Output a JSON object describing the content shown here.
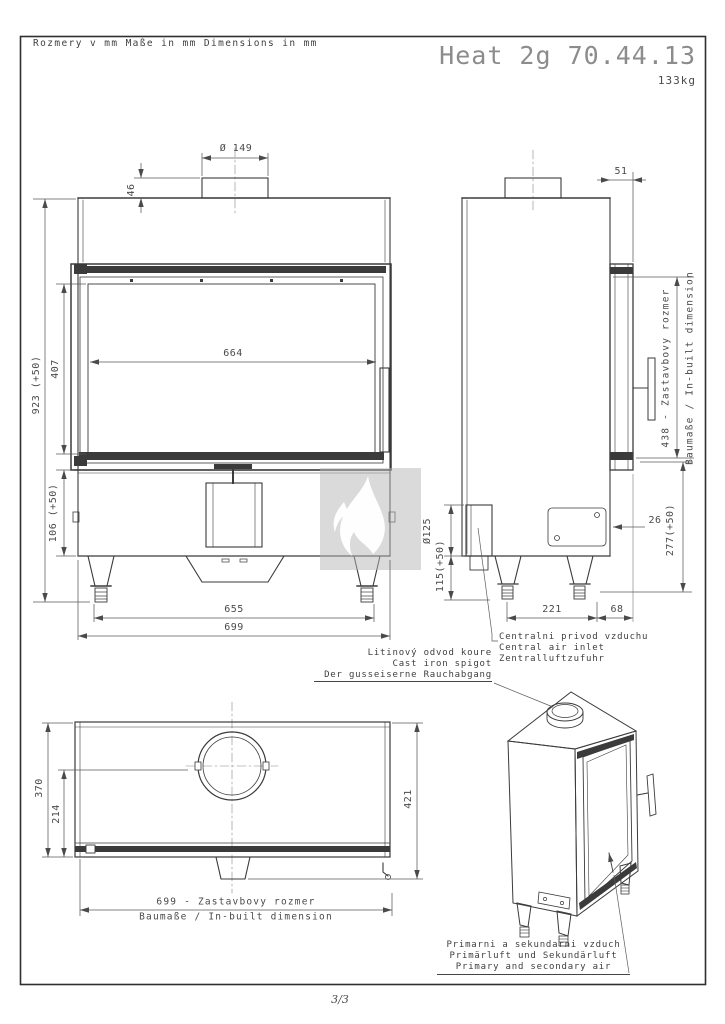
{
  "header": {
    "units": [
      "Rozmery v mm",
      "Maße in mm",
      "Dimensions in mm"
    ],
    "title": "Heat 2g 70.44.13",
    "weight": "133kg"
  },
  "front_view": {
    "flue_dia": "Ø 149",
    "collar_h": "46",
    "total_h": "923 (+50)",
    "door_h": "407",
    "glass_w": "664",
    "base_h": "106 (+50)",
    "feet_w": "655",
    "total_w": "699"
  },
  "side_view": {
    "front_offset": "51",
    "inbuilt_1": "438 - Zastavbovy rozmer",
    "inbuilt_2": "Baumaße / In-built dimension",
    "door_gap": "26",
    "base_h": "277(+50)",
    "air_dia": "Ø125",
    "air_h": "115(+50)",
    "feet_d": "221",
    "rear_d": "68"
  },
  "plan_view": {
    "depth": "370",
    "glass_d": "214",
    "body_d": "421",
    "inbuilt_1": "699 - Zastavbovy rozmer",
    "inbuilt_2": "Baumaße / In-built dimension"
  },
  "annotations": {
    "air_inlet": [
      "Centralni privod vzduchu",
      "Central air inlet",
      "Zentralluftzufuhr"
    ],
    "spigot": [
      "Litinový odvod koure",
      "Cast iron spigot",
      "Der gusseiserne Rauchabgang"
    ],
    "primary_air": [
      "Primarni a sekundarni vzduch",
      "Primärluft und Sekundärluft",
      "Primary and secondary air"
    ]
  },
  "footer": {
    "page": "3/3"
  },
  "colors": {
    "ink": "#3b3b3b",
    "dim": "#5a5a5a",
    "watermark": "#b5b5b5",
    "flame": "#ffffff"
  }
}
